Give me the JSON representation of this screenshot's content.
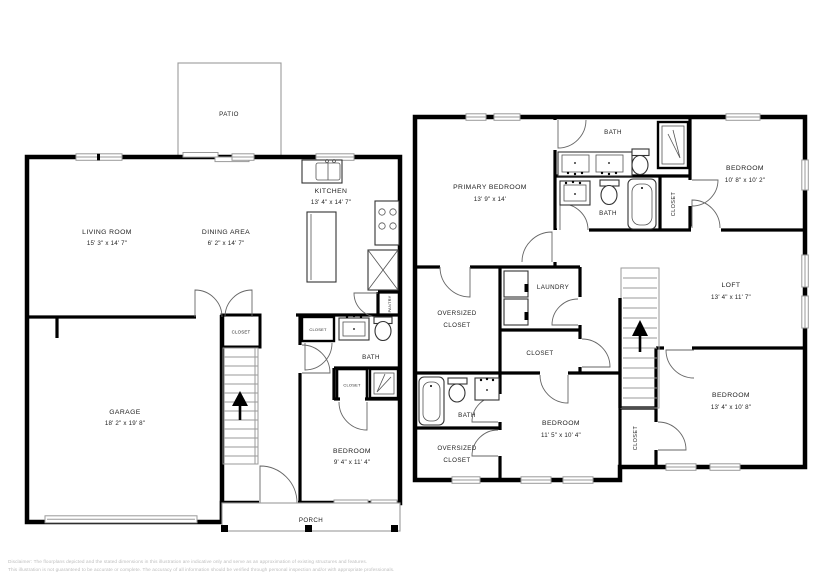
{
  "floor1": {
    "patio": {
      "label": "PATIO"
    },
    "living_room": {
      "label": "LIVING ROOM",
      "dims": "15' 3\" x 14' 7\""
    },
    "dining_area": {
      "label": "DINING AREA",
      "dims": "6' 2\" x 14' 7\""
    },
    "kitchen": {
      "label": "KITCHEN",
      "dims": "13' 4\" x 14' 7\""
    },
    "pantry": {
      "label": "PANTRY"
    },
    "garage": {
      "label": "GARAGE",
      "dims": "18' 2\" x 19' 8\""
    },
    "stair_closet": {
      "label": "CLOSET"
    },
    "hall_closet": {
      "label": "CLOSET"
    },
    "bath": {
      "label": "BATH"
    },
    "bath_closet": {
      "label": "CLOSET"
    },
    "bedroom": {
      "label": "BEDROOM",
      "dims": "9' 4\" x 11' 4\""
    },
    "porch": {
      "label": "PORCH"
    }
  },
  "floor2": {
    "primary_bedroom": {
      "label": "PRIMARY BEDROOM",
      "dims": "13' 9\" x 14'"
    },
    "bath_upper": {
      "label": "BATH"
    },
    "bath_lower": {
      "label": "BATH"
    },
    "bath_closet": {
      "label": "CLOSET"
    },
    "bedroom_2": {
      "label": "BEDROOM",
      "dims": "10' 8\" x 10' 2\""
    },
    "oversized_closet_upper": {
      "line1": "OVERSIZED",
      "line2": "CLOSET"
    },
    "laundry": {
      "label": "LAUNDRY"
    },
    "hall_closet": {
      "label": "CLOSET"
    },
    "loft": {
      "label": "LOFT",
      "dims": "13' 4\" x 11' 7\""
    },
    "bath_hall": {
      "label": "BATH"
    },
    "oversized_closet_lower": {
      "line1": "OVERSIZED",
      "line2": "CLOSET"
    },
    "bedroom_3": {
      "label": "BEDROOM",
      "dims": "11' 5\" x 10' 4\""
    },
    "bedroom_4_closet": {
      "label": "CLOSET"
    },
    "bedroom_4": {
      "label": "BEDROOM",
      "dims": "13' 4\" x 10' 8\""
    }
  },
  "disclaimer": {
    "line1": "Disclaimer: The floorplans depicted and the stated dimensions in this illustration are indicative only and serve as an approximation of existing structures and features.",
    "line2": "This illustration is not guaranteed to be accurate or complete. The accuracy of all information should be verified through personal inspection and/or with appropriate professionals."
  }
}
